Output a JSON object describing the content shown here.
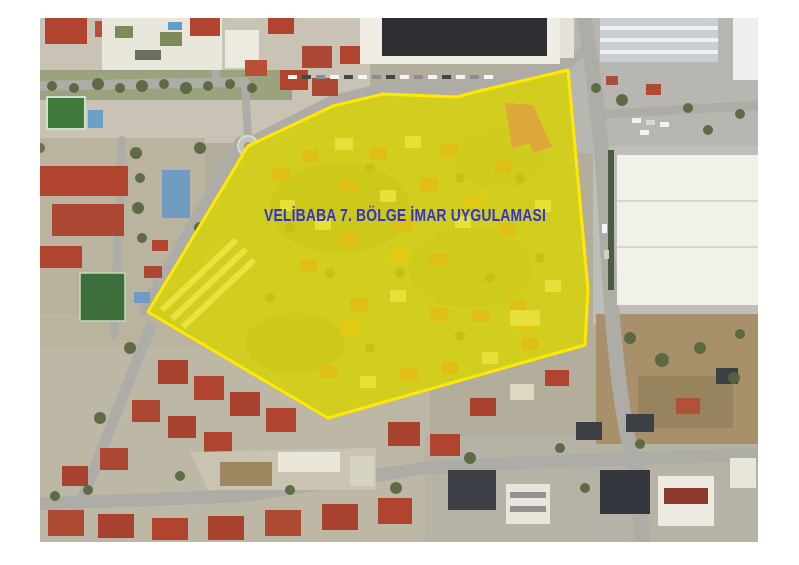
{
  "page": {
    "background_color": "#ffffff"
  },
  "map": {
    "type": "aerial-satellite-photo",
    "overlay": {
      "label": "VELİBABA 7. BÖLGE İMAR UYGULAMASI",
      "label_color": "#3333cc",
      "fill_color": "#ede400",
      "fill_opacity": "0.7",
      "stroke_color": "#ffe900",
      "stroke_width": "3",
      "polygon_points": "528,52 435,74 417,79 343,76 293,88 208,128 108,294 288,400 545,327 548,272",
      "interior_base_color": "#93996c"
    },
    "highlight_building": {
      "fill_color": "#dfa33c",
      "points": "465,85 493,87 512,129 493,135 490,125 472,130"
    }
  }
}
